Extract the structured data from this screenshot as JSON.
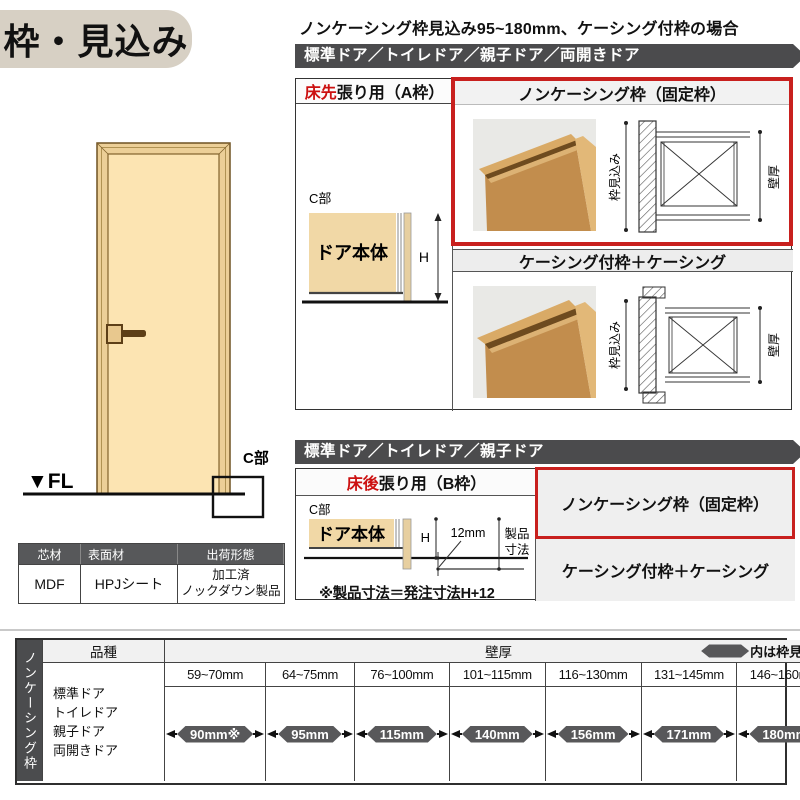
{
  "title": "枠・見込み",
  "subtitle": "ノンケーシング枠見込み95~180mm、ケーシング付枠の場合",
  "section_a": {
    "bar": "標準ドア／トイレドア／親子ドア／両開きドア",
    "left_header_red": "床先",
    "left_header_rest": "張り用（A枠）",
    "noncasing_header": "ノンケーシング枠（固定枠）",
    "casing_header": "ケーシング付枠＋ケーシング",
    "c_label": "C部",
    "door_body": "ドア本体",
    "h_label": "H",
    "frame_depth": "枠見込み",
    "wall_thickness": "壁厚"
  },
  "door_figure": {
    "fl": "▼FL",
    "c_label": "C部"
  },
  "material_table": {
    "headers": [
      "芯材",
      "表面材",
      "出荷形態"
    ],
    "core": "MDF",
    "surface": "HPJシート",
    "shipping_line1": "加工済",
    "shipping_line2": "ノックダウン製品"
  },
  "section_b": {
    "bar": "標準ドア／トイレドア／親子ドア",
    "left_header_red": "床後",
    "left_header_rest": "張り用（B枠）",
    "noncasing_label": "ノンケーシング枠（固定枠）",
    "casing_label": "ケーシング付枠＋ケーシング",
    "c_label": "C部",
    "door_body": "ドア本体",
    "h_label": "H",
    "gap": "12mm",
    "product_line1": "製品",
    "product_line2": "寸法",
    "note": "※製品寸法＝発注寸法H+12"
  },
  "size_table": {
    "vertical_label": "ノンケーシング枠",
    "kind_header": "品種",
    "wall_header": "壁厚",
    "legend": "内は枠見込み",
    "door_types": [
      "標準ドア",
      "トイレドア",
      "親子ドア",
      "両開きドア"
    ],
    "columns": [
      {
        "range": "59~70mm",
        "depth": "90mm※"
      },
      {
        "range": "64~75mm",
        "depth": "95mm"
      },
      {
        "range": "76~100mm",
        "depth": "115mm"
      },
      {
        "range": "101~115mm",
        "depth": "140mm"
      },
      {
        "range": "116~130mm",
        "depth": "156mm"
      },
      {
        "range": "131~145mm",
        "depth": "171mm"
      },
      {
        "range": "146~160mm",
        "depth": "180mm"
      }
    ]
  },
  "colors": {
    "accent_red": "#c8201e",
    "bar_gray": "#4b4b4d",
    "badge_gray": "#58585a",
    "tan_fill": "#f1d8a6",
    "title_bg": "#d7d0c4"
  }
}
